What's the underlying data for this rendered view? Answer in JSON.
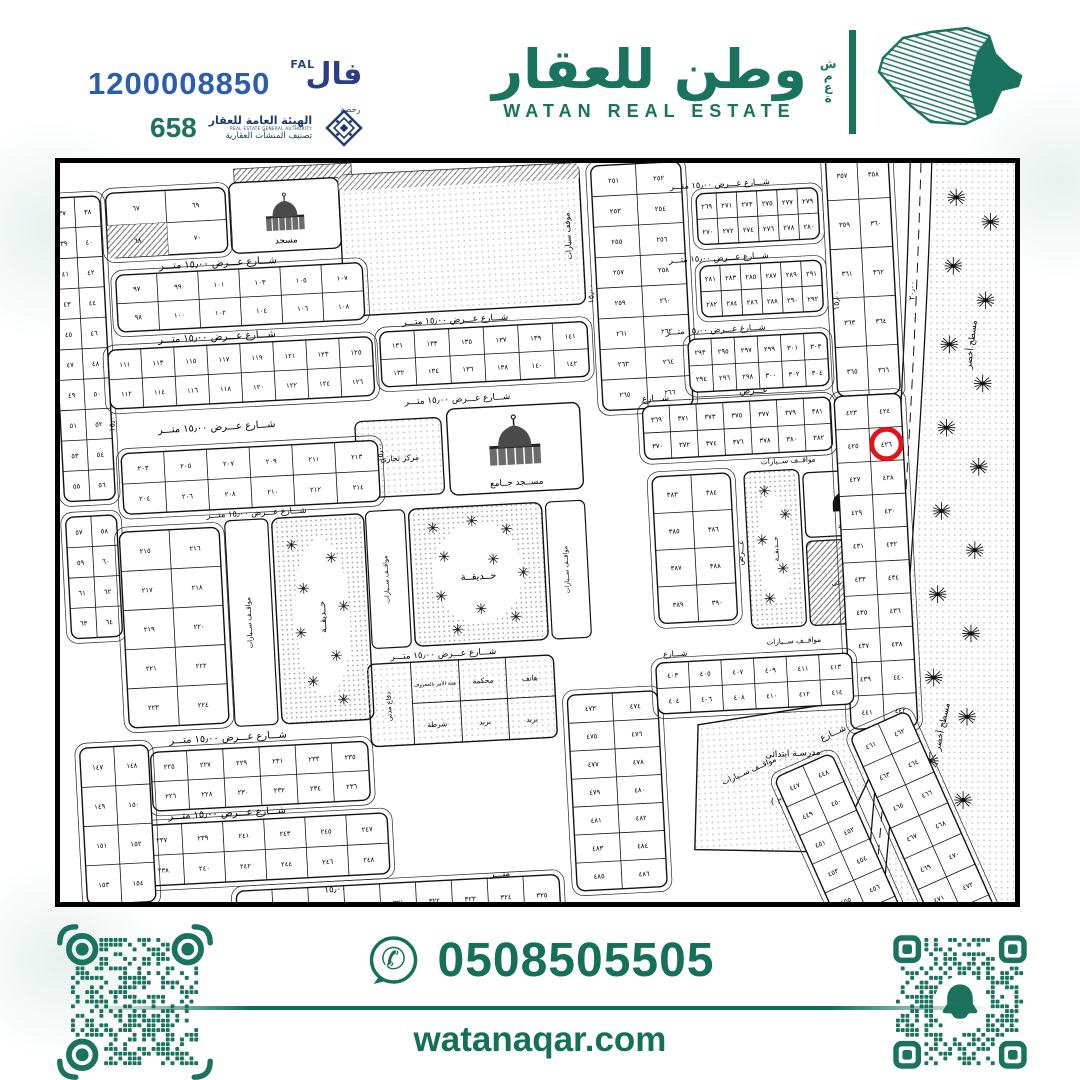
{
  "header": {
    "fal_number": "1200008850",
    "fal_logo": {
      "ar": "فال",
      "en": "FAL",
      "sub": "رخصة"
    },
    "rega_number": "658",
    "rega": {
      "l1": "الهيئة العامة للعقار",
      "l2": "REAL ESTATE GENERAL AUTHORITY",
      "l3": "تصنيف المنشآت العقارية"
    },
    "brand": {
      "ar": "وطن للعقار",
      "en": "WATAN REAL ESTATE",
      "side_word": "شمعة"
    }
  },
  "footer": {
    "phone": "0508505505",
    "site": "watanaqar.com"
  },
  "colors": {
    "green": "#1A735E",
    "blue": "#2B5DAD",
    "navy": "#1B3A6B",
    "red": "#E3131B"
  },
  "map": {
    "labels": {
      "mosque": "مسجد",
      "grand_mosque": "مســجد جــامع",
      "park": "حــديقــة",
      "parking": "مواقــف ســيارات",
      "parking2": "موقف سيارات",
      "commercial": "مركز تجارى",
      "submarket": "سـوق فرعى",
      "court": "محكمة",
      "telephone": "هاتف",
      "hisba": "هيئة الأمر بالمعروف",
      "civil_defense": "دفاع مدنى",
      "post": "بريد",
      "police": "شرطة",
      "school_l1": "مدرسـة ابتدائى",
      "school_l2": "بنـات",
      "school_l3": "منطقــة ( ٢ )",
      "green_area": "مسطح أخضر",
      "street15": "شـــارع عـــرض ١٥٫٠٠ متـــر",
      "street": "شـــارع",
      "width_word": "عـــرض",
      "meter_word": "متـــر",
      "w15": "١٥٫٠٠",
      "w20": "٢٠٫٠٠"
    },
    "highlight_plot": "٤٢٦",
    "blocks": [
      {
        "x": 6,
        "y": 14,
        "w": 52,
        "h": 310,
        "rows": 10,
        "cols": 2,
        "start": 37,
        "order": "row"
      },
      {
        "x": 6,
        "y": 340,
        "w": 52,
        "h": 124,
        "rows": 4,
        "cols": 2,
        "start": 57,
        "order": "row"
      },
      {
        "x": 64,
        "y": 12,
        "w": 122,
        "h": 66,
        "rows": 2,
        "cols": 2,
        "start": 67,
        "order": "col",
        "hatch": [
          2
        ]
      },
      {
        "x": 70,
        "y": 96,
        "w": 252,
        "h": 58,
        "rows": 2,
        "cols": 6,
        "start": 97,
        "order": "col"
      },
      {
        "x": 58,
        "y": 172,
        "w": 270,
        "h": 60,
        "rows": 2,
        "cols": 8,
        "start": 111,
        "order": "col"
      },
      {
        "x": 66,
        "y": 278,
        "w": 262,
        "h": 62,
        "rows": 2,
        "cols": 6,
        "start": 203,
        "order": "col"
      },
      {
        "x": 60,
        "y": 358,
        "w": 102,
        "h": 200,
        "rows": 5,
        "cols": 2,
        "start": 215,
        "order": "row"
      },
      {
        "x": 80,
        "y": 584,
        "w": 222,
        "h": 60,
        "rows": 2,
        "cols": 6,
        "start": 225,
        "order": "col"
      },
      {
        "x": 66,
        "y": 658,
        "w": 252,
        "h": 62,
        "rows": 2,
        "cols": 6,
        "start": 237,
        "order": "col"
      },
      {
        "x": 8,
        "y": 576,
        "w": 70,
        "h": 160,
        "rows": 4,
        "cols": 2,
        "start": 147,
        "order": "row"
      },
      {
        "x": 336,
        "y": 168,
        "w": 212,
        "h": 56,
        "rows": 2,
        "cols": 6,
        "start": 131,
        "order": "col"
      },
      {
        "x": 560,
        "y": 10,
        "w": 92,
        "h": 250,
        "rows": 8,
        "cols": 2,
        "start": 251,
        "order": "row"
      },
      {
        "x": 666,
        "y": 44,
        "w": 124,
        "h": 52,
        "rows": 2,
        "cols": 6,
        "start": 269,
        "order": "col"
      },
      {
        "x": 800,
        "y": 8,
        "w": 64,
        "h": 250,
        "rows": 5,
        "cols": 2,
        "start": 357,
        "order": "row"
      },
      {
        "x": 666,
        "y": 118,
        "w": 124,
        "h": 52,
        "rows": 2,
        "cols": 6,
        "start": 281,
        "order": "col"
      },
      {
        "x": 650,
        "y": 192,
        "w": 142,
        "h": 54,
        "rows": 2,
        "cols": 6,
        "start": 293,
        "order": "col"
      },
      {
        "x": 600,
        "y": 258,
        "w": 192,
        "h": 54,
        "rows": 2,
        "cols": 7,
        "start": 369,
        "order": "col"
      },
      {
        "x": 606,
        "y": 330,
        "w": 80,
        "h": 150,
        "rows": 4,
        "cols": 2,
        "start": 383,
        "order": "row"
      },
      {
        "x": 796,
        "y": 258,
        "w": 68,
        "h": 340,
        "rows": 10,
        "cols": 2,
        "start": 423,
        "order": "row",
        "circle": 3
      },
      {
        "x": 508,
        "y": 548,
        "w": 92,
        "h": 200,
        "rows": 7,
        "cols": 2,
        "start": 473,
        "order": "row"
      },
      {
        "x": 600,
        "y": 520,
        "w": 200,
        "h": 52,
        "rows": 2,
        "cols": 6,
        "start": 403,
        "order": "col"
      },
      {
        "x": 160,
        "y": 730,
        "w": 330,
        "h": 40,
        "rows": 1,
        "cols": 9,
        "start": 317,
        "order": "row"
      },
      {
        "x": 740,
        "y": 600,
        "w": 64,
        "h": 224,
        "rows": 7,
        "cols": 2,
        "start": 447,
        "order": "row",
        "g": "diag"
      },
      {
        "x": 828,
        "y": 592,
        "w": 64,
        "h": 240,
        "rows": 7,
        "cols": 2,
        "start": 461,
        "order": "row",
        "g": "diag"
      }
    ],
    "street_texts": [
      {
        "x": 115,
        "y": 92,
        "k": "street15"
      },
      {
        "x": 110,
        "y": 167,
        "k": "street15"
      },
      {
        "x": 105,
        "y": 259,
        "k": "street15"
      },
      {
        "x": 150,
        "y": 348,
        "k": "street15",
        "fs": 8.5
      },
      {
        "x": 100,
        "y": 576,
        "k": "street15"
      },
      {
        "x": 95,
        "y": 653,
        "k": "street15"
      },
      {
        "x": 30,
        "y": 740,
        "k": "width_word",
        "fs": 9
      },
      {
        "x": 250,
        "y": 736,
        "k": "w15",
        "fs": 9
      },
      {
        "x": 420,
        "y": 729,
        "k": "meter_word",
        "fs": 9
      },
      {
        "x": 360,
        "y": 162,
        "k": "street15",
        "fs": 9
      },
      {
        "x": 358,
        "y": 243,
        "k": "street15",
        "fs": 9
      },
      {
        "x": 330,
        "y": 502,
        "k": "street15",
        "fs": 9
      },
      {
        "x": 640,
        "y": 38,
        "k": "street15",
        "fs": 8.5
      },
      {
        "x": 635,
        "y": 113,
        "k": "street15",
        "fs": 8.5
      },
      {
        "x": 628,
        "y": 186,
        "k": "street15",
        "fs": 8.5
      },
      {
        "x": 600,
        "y": 253,
        "k": "street",
        "fs": 9
      },
      {
        "x": 700,
        "y": 250,
        "k": "width_word",
        "fs": 9
      },
      {
        "x": 718,
        "y": 323,
        "k": "parking",
        "fs": 7.5
      },
      {
        "x": 714,
        "y": 507,
        "k": "parking",
        "fs": 7.5
      },
      {
        "x": 608,
        "y": 514,
        "k": "street",
        "fs": 8
      },
      {
        "x": 61,
        "y": 255,
        "k": "w15",
        "rot": -90,
        "fs": 8
      },
      {
        "x": 333,
        "y": 300,
        "k": "w15",
        "rot": -90,
        "fs": 8
      },
      {
        "x": 556,
        "y": 150,
        "k": "w15",
        "rot": -88,
        "fs": 8
      },
      {
        "x": 694,
        "y": 425,
        "k": "width_word",
        "rot": -85,
        "fs": 8
      },
      {
        "x": 806,
        "y": 170,
        "k": "w15",
        "rot": -87,
        "fs": 8
      },
      {
        "x": 690,
        "y": 585,
        "k": "parking",
        "fs": 8,
        "g": "diag"
      },
      {
        "x": 800,
        "y": 585,
        "k": "street",
        "fs": 9,
        "g": "diag"
      },
      {
        "x": 700,
        "y": 845,
        "k": "street",
        "fs": 9,
        "g": "diag"
      },
      {
        "x": 930,
        "y": 210,
        "k": "green_area",
        "rot": -83,
        "fs": 9,
        "g": "flat"
      },
      {
        "x": 898,
        "y": 600,
        "k": "green_area",
        "rot": -78,
        "fs": 9,
        "g": "flat"
      },
      {
        "x": 872,
        "y": 140,
        "k": "w20",
        "rot": -87,
        "fs": 8,
        "g": "flat"
      }
    ],
    "palms": [
      [
        915,
        35
      ],
      [
        950,
        60
      ],
      [
        912,
        105
      ],
      [
        945,
        140
      ],
      [
        908,
        185
      ],
      [
        942,
        225
      ],
      [
        905,
        270
      ],
      [
        938,
        310
      ],
      [
        900,
        355
      ],
      [
        934,
        395
      ],
      [
        896,
        440
      ],
      [
        930,
        480
      ],
      [
        892,
        525
      ],
      [
        926,
        565
      ],
      [
        888,
        610
      ],
      [
        922,
        650
      ],
      [
        885,
        695
      ],
      [
        918,
        730
      ]
    ],
    "trees": [
      [
        380,
        370
      ],
      [
        420,
        365
      ],
      [
        455,
        375
      ],
      [
        390,
        400
      ],
      [
        440,
        405
      ],
      [
        470,
        420
      ],
      [
        385,
        440
      ],
      [
        425,
        455
      ],
      [
        460,
        465
      ],
      [
        400,
        475
      ],
      [
        235,
        380
      ],
      [
        275,
        395
      ],
      [
        245,
        425
      ],
      [
        285,
        445
      ],
      [
        240,
        470
      ],
      [
        275,
        495
      ],
      [
        250,
        520
      ],
      [
        280,
        540
      ],
      [
        720,
        350
      ],
      [
        740,
        375
      ],
      [
        715,
        400
      ],
      [
        735,
        430
      ],
      [
        720,
        460
      ]
    ]
  }
}
